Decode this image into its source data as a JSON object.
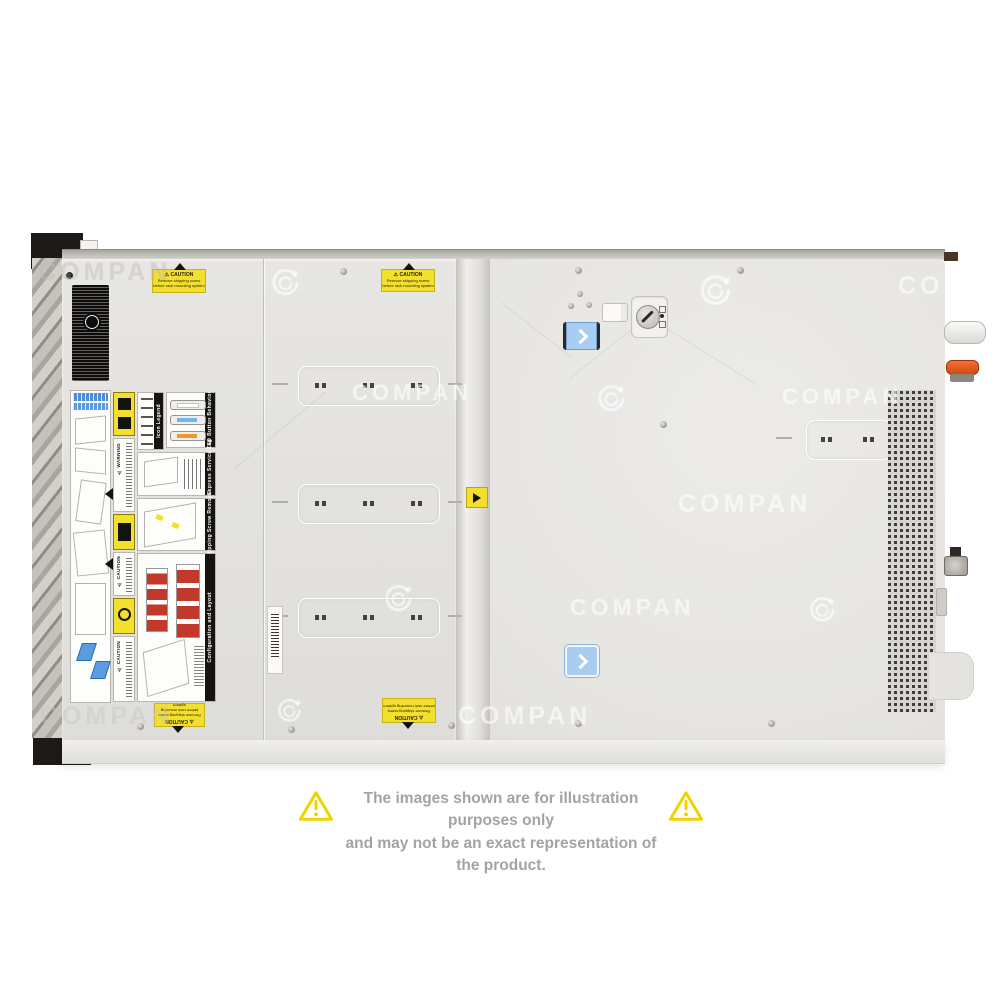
{
  "watermark": {
    "text": "COMPAN"
  },
  "disclaimer": {
    "line1": "The images shown are for illustration purposes only",
    "line2": "and may not be an exact representation of the product."
  },
  "server": {
    "caution_sticker": {
      "title": "⚠ CAUTION",
      "line1": "Remove shipping screw",
      "line2": "before rack mounting system"
    },
    "labels": {
      "warning_title": "⚠ WARNING",
      "caution_title": "⚠ CAUTION",
      "icon_legend_header": "Icon Legend",
      "led_button_header": "LED Button Behavior",
      "service_tag_header": "Rear Express Service Tag",
      "shipping_screw_header": "Shipping Screw Removal",
      "config_header": "Configuration and Layout"
    }
  },
  "colors": {
    "chassis": "#e5e4e1",
    "accent_yellow": "#f2df2e",
    "latch_blue": "#a9cdf0",
    "lever_orange": "#e8571d",
    "label_red": "#c4372b",
    "warning_triangle": "#f0d400",
    "disclaimer_text": "#a3a3a3"
  }
}
